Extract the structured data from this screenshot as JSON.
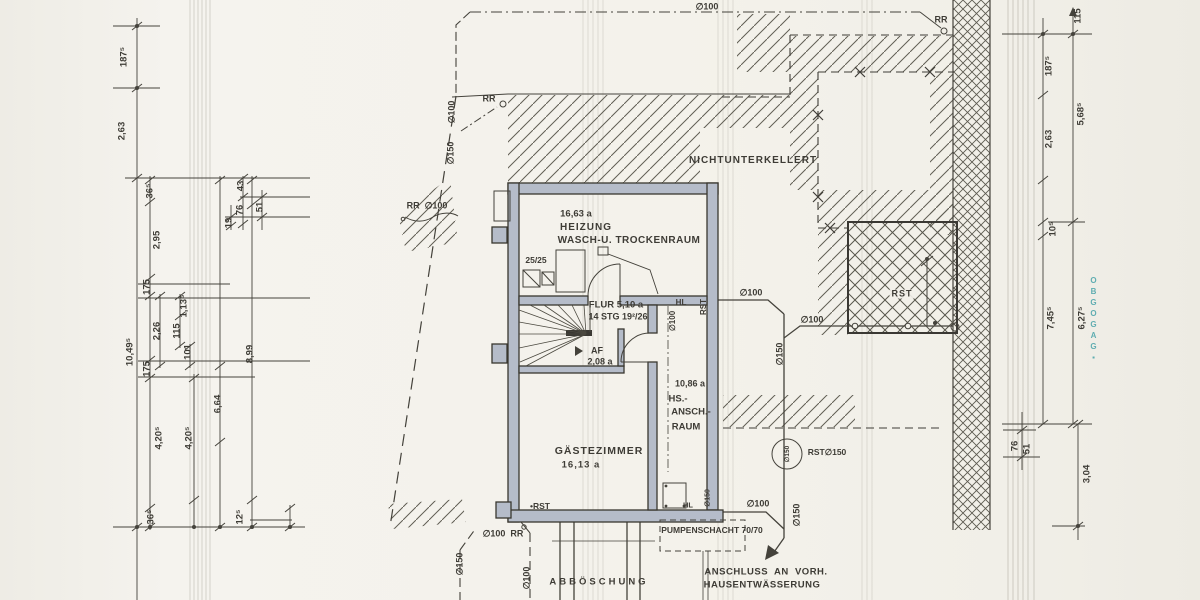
{
  "colors": {
    "paper": "#f3f1ea",
    "ink": "#3e3c36",
    "wall_fill": "#b5bcc9",
    "hatch": "#5b584e",
    "stamp_teal": "#2f98a0"
  },
  "drawing": {
    "type": "basement-floor-and-site-plan",
    "language": "de"
  },
  "labels": [
    {
      "n": "dim-left-1875",
      "t": "187⁵",
      "x": 124,
      "y": 57,
      "r": -90
    },
    {
      "n": "dim-left-263",
      "t": "2,63",
      "x": 122,
      "y": 131,
      "r": -90
    },
    {
      "n": "dim-left-365-top",
      "t": "36⁵",
      "x": 150,
      "y": 191,
      "r": -90
    },
    {
      "n": "dim-left-43",
      "t": "43",
      "x": 241,
      "y": 186,
      "r": -90
    },
    {
      "n": "dim-left-76",
      "t": "76",
      "x": 240,
      "y": 210,
      "r": -90
    },
    {
      "n": "dim-left-19",
      "t": "19",
      "x": 229,
      "y": 223,
      "r": -90
    },
    {
      "n": "dim-left-51",
      "t": "51",
      "x": 260,
      "y": 207,
      "r": -90
    },
    {
      "n": "dim-left-295",
      "t": "2,95",
      "x": 157,
      "y": 240,
      "r": -90
    },
    {
      "n": "dim-left-175-a",
      "t": "175",
      "x": 147,
      "y": 287,
      "r": -90
    },
    {
      "n": "dim-left-226",
      "t": "2,26",
      "x": 157,
      "y": 331,
      "r": -90
    },
    {
      "n": "dim-left-1135",
      "t": "1,13⁵",
      "x": 184,
      "y": 306,
      "r": -90
    },
    {
      "n": "dim-left-115",
      "t": "115",
      "x": 177,
      "y": 331,
      "r": -90
    },
    {
      "n": "dim-left-101",
      "t": "101",
      "x": 188,
      "y": 352,
      "r": -90
    },
    {
      "n": "dim-left-10495",
      "t": "10,49⁵",
      "x": 130,
      "y": 352,
      "r": -90
    },
    {
      "n": "dim-left-899",
      "t": "8,99",
      "x": 250,
      "y": 354,
      "r": -90
    },
    {
      "n": "dim-left-664",
      "t": "6,64",
      "x": 218,
      "y": 404,
      "r": -90
    },
    {
      "n": "dim-left-175-b",
      "t": "175",
      "x": 147,
      "y": 369,
      "r": -90
    },
    {
      "n": "dim-left-4205-a",
      "t": "4,20⁵",
      "x": 159,
      "y": 438,
      "r": -90
    },
    {
      "n": "dim-left-4205-b",
      "t": "4,20⁵",
      "x": 189,
      "y": 438,
      "r": -90
    },
    {
      "n": "dim-left-365-bottom",
      "t": "36⁵",
      "x": 151,
      "y": 517,
      "r": -90
    },
    {
      "n": "dim-left-125",
      "t": "12⁵",
      "x": 240,
      "y": 517,
      "r": -90
    },
    {
      "n": "dim-right-115",
      "t": "115",
      "x": 1078,
      "y": 16,
      "r": -90
    },
    {
      "n": "dim-right-1875",
      "t": "187⁵",
      "x": 1049,
      "y": 66,
      "r": -90
    },
    {
      "n": "dim-right-263",
      "t": "2,63",
      "x": 1049,
      "y": 139,
      "r": -90
    },
    {
      "n": "dim-right-5685",
      "t": "5,68⁵",
      "x": 1081,
      "y": 114,
      "r": -90
    },
    {
      "n": "dim-right-105",
      "t": "10⁵",
      "x": 1053,
      "y": 229,
      "r": -90
    },
    {
      "n": "dim-right-7455",
      "t": "7,45⁵",
      "x": 1051,
      "y": 318,
      "r": -90
    },
    {
      "n": "dim-right-6275",
      "t": "6,27⁵",
      "x": 1082,
      "y": 318,
      "r": -90
    },
    {
      "n": "dim-right-76",
      "t": "76",
      "x": 1015,
      "y": 446,
      "r": -90
    },
    {
      "n": "dim-right-51",
      "t": "51",
      "x": 1027,
      "y": 449,
      "r": -90
    },
    {
      "n": "dim-right-304",
      "t": "3,04",
      "x": 1087,
      "y": 474,
      "r": -90
    },
    {
      "n": "pipe-100-top",
      "t": "∅100",
      "x": 707,
      "y": 7,
      "fs": 9
    },
    {
      "n": "rr-top-left",
      "t": "RR",
      "x": 489,
      "y": 99,
      "fs": 9
    },
    {
      "n": "pipe-100-left",
      "t": "∅100",
      "x": 452,
      "y": 112,
      "r": -90,
      "fs": 9
    },
    {
      "n": "pipe-150-left",
      "t": "∅150",
      "x": 451,
      "y": 153,
      "r": -90,
      "fs": 9
    },
    {
      "n": "rr-100-left",
      "t": "RR  ∅100",
      "x": 427,
      "y": 206,
      "fs": 9
    },
    {
      "n": "rr-top-right",
      "t": "RR",
      "x": 941,
      "y": 20,
      "fs": 9
    },
    {
      "n": "pipe-100-right-a",
      "t": "∅100",
      "x": 751,
      "y": 293,
      "fs": 9
    },
    {
      "n": "pipe-100-right-b",
      "t": "∅100",
      "x": 812,
      "y": 320,
      "fs": 9
    },
    {
      "n": "pipe-150-right",
      "t": "∅150",
      "x": 780,
      "y": 354,
      "r": -90,
      "fs": 9
    },
    {
      "n": "rst-terrace",
      "t": "RST",
      "x": 902,
      "y": 294,
      "fs": 9,
      "ls": 1,
      "bg": 1
    },
    {
      "n": "rst-150-label",
      "t": "RST∅150",
      "x": 827,
      "y": 452,
      "fs": 8.5
    },
    {
      "n": "rst-150-circle-text",
      "t": "∅150",
      "x": 788,
      "y": 454,
      "r": -90,
      "fs": 6.5
    },
    {
      "n": "pipe-100-bottom-right",
      "t": "∅100",
      "x": 758,
      "y": 504,
      "fs": 9
    },
    {
      "n": "pipe-150-bottom-right",
      "t": "∅150",
      "x": 797,
      "y": 515,
      "r": -90,
      "fs": 9
    },
    {
      "n": "pipe-100-rr-bottom",
      "t": "∅100  RR",
      "x": 503,
      "y": 534,
      "fs": 9
    },
    {
      "n": "pipe-150-bottom-left",
      "t": "∅150",
      "x": 460,
      "y": 564,
      "r": -90,
      "fs": 9
    },
    {
      "n": "pipe-100-bottom-left",
      "t": "∅100",
      "x": 527,
      "y": 578,
      "r": -90,
      "fs": 9
    },
    {
      "n": "hl-top",
      "t": "HL",
      "x": 681,
      "y": 303,
      "fs": 8
    },
    {
      "n": "pipe-100-hs",
      "t": "∅100",
      "x": 673,
      "y": 321,
      "r": -90,
      "fs": 8
    },
    {
      "n": "rst-wall",
      "t": "RST",
      "x": 704,
      "y": 307,
      "r": -90,
      "fs": 8
    },
    {
      "n": "hl-bottom",
      "t": "HL",
      "x": 688,
      "y": 505,
      "fs": 7.5
    },
    {
      "n": "pipe-150-hs",
      "t": "∅150",
      "x": 708,
      "y": 498,
      "r": -90,
      "fs": 7
    },
    {
      "n": "rst-gaeste",
      "t": "•RST",
      "x": 540,
      "y": 506,
      "fs": 8.5
    },
    {
      "n": "room-heizung-area",
      "t": "16,63 a",
      "x": 576,
      "y": 214,
      "fs": 9.5
    },
    {
      "n": "room-heizung-name",
      "t": "HEIZUNG",
      "x": 586,
      "y": 228,
      "fs": 10,
      "ls": 1
    },
    {
      "n": "room-heizung-name2",
      "t": "WASCH-U. TROCKENRAUM",
      "x": 629,
      "y": 241,
      "fs": 10,
      "ls": 0.5
    },
    {
      "n": "chimney-size",
      "t": "25/25",
      "x": 536,
      "y": 260,
      "fs": 8.5
    },
    {
      "n": "room-flur",
      "t": "FLUR 5,10 a",
      "x": 616,
      "y": 305,
      "fs": 9.5,
      "w": 700
    },
    {
      "n": "stair-note",
      "t": "14 STG 19²/26",
      "x": 618,
      "y": 317,
      "fs": 9
    },
    {
      "n": "room-af",
      "t": "AF",
      "x": 597,
      "y": 351,
      "fs": 9
    },
    {
      "n": "room-af-area",
      "t": "2,08 a",
      "x": 600,
      "y": 362,
      "fs": 9
    },
    {
      "n": "room-hs-area",
      "t": "10,86 a",
      "x": 690,
      "y": 384,
      "fs": 9
    },
    {
      "n": "room-hs-1",
      "t": "HS.-",
      "x": 678,
      "y": 399,
      "fs": 9.5
    },
    {
      "n": "room-hs-2",
      "t": "ANSCH.-",
      "x": 691,
      "y": 412,
      "fs": 9.5
    },
    {
      "n": "room-hs-3",
      "t": "RAUM",
      "x": 686,
      "y": 427,
      "fs": 9.5
    },
    {
      "n": "room-gaeste",
      "t": "GÄSTEZIMMER",
      "x": 599,
      "y": 451,
      "fs": 10.5,
      "ls": 1,
      "w": 700
    },
    {
      "n": "room-gaeste-area",
      "t": "16,13 a",
      "x": 581,
      "y": 465,
      "fs": 9.5,
      "ls": 1
    },
    {
      "n": "note-nichtunterkellert",
      "t": "NICHTUNTERKELLERT",
      "x": 753,
      "y": 161,
      "fs": 10,
      "ls": 1
    },
    {
      "n": "pumpenschacht",
      "t": "PUMPENSCHACHT 70/70",
      "x": 712,
      "y": 530,
      "fs": 8.5
    },
    {
      "n": "note-anschluss-1",
      "t": "ANSCHLUSS  AN  VORH.",
      "x": 766,
      "y": 572,
      "fs": 9.5,
      "ls": 0.5,
      "w": 700
    },
    {
      "n": "note-anschluss-2",
      "t": "HAUSENTWÄSSERUNG",
      "x": 762,
      "y": 585,
      "fs": 9.5,
      "ls": 0.5,
      "w": 700
    },
    {
      "n": "note-abboeschung",
      "t": "ABBÖSCHUNG",
      "x": 599,
      "y": 582,
      "fs": 9.5,
      "ls": 3
    },
    {
      "n": "stamp-text",
      "t": "OBGOGAG▪",
      "x": 1093,
      "y": 320,
      "fs": 8,
      "c": "#2f98a0",
      "stack": 1,
      "ls": 2
    }
  ]
}
